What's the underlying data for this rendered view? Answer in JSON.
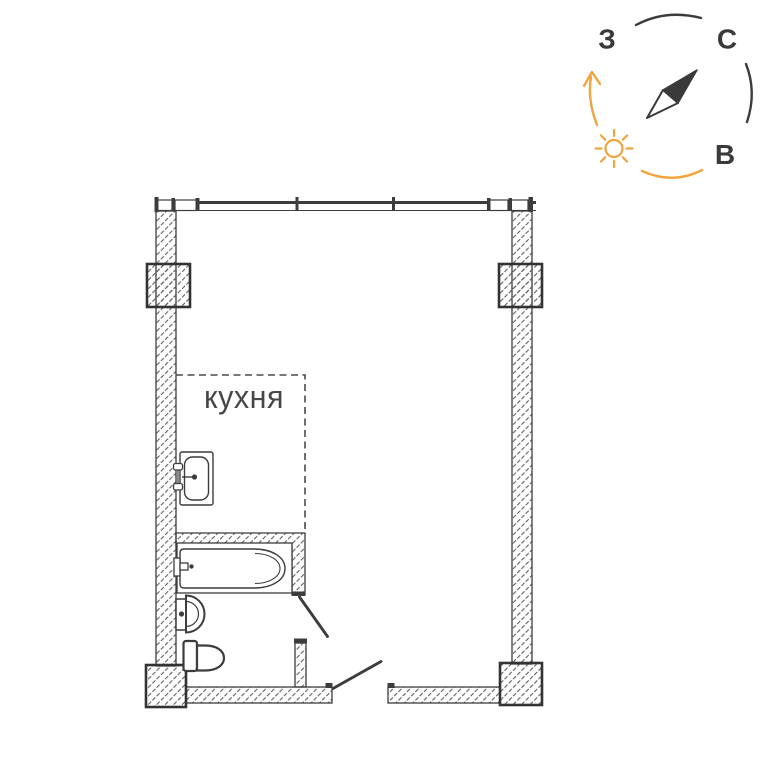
{
  "page": {
    "background": "#ffffff"
  },
  "compass": {
    "labels": {
      "west": "З",
      "north": "С",
      "east": "В"
    },
    "colors": {
      "accent": "#F0A43E",
      "ink": "#3A3A3A"
    },
    "icons": [
      "sun-icon",
      "compass-needle-icon",
      "curved-arrow-icon"
    ]
  },
  "floor_plan": {
    "rooms": {
      "kitchen": {
        "label": "кухня"
      }
    },
    "colors": {
      "ink": "#3C3C3C",
      "hatch": "#606060",
      "dashed_boundary": "#4A4A4A"
    },
    "fixtures": [
      "kitchen-sink",
      "bathtub",
      "washbasin",
      "toilet"
    ],
    "openings": [
      "window-band",
      "bathroom-door",
      "entrance-door"
    ]
  }
}
